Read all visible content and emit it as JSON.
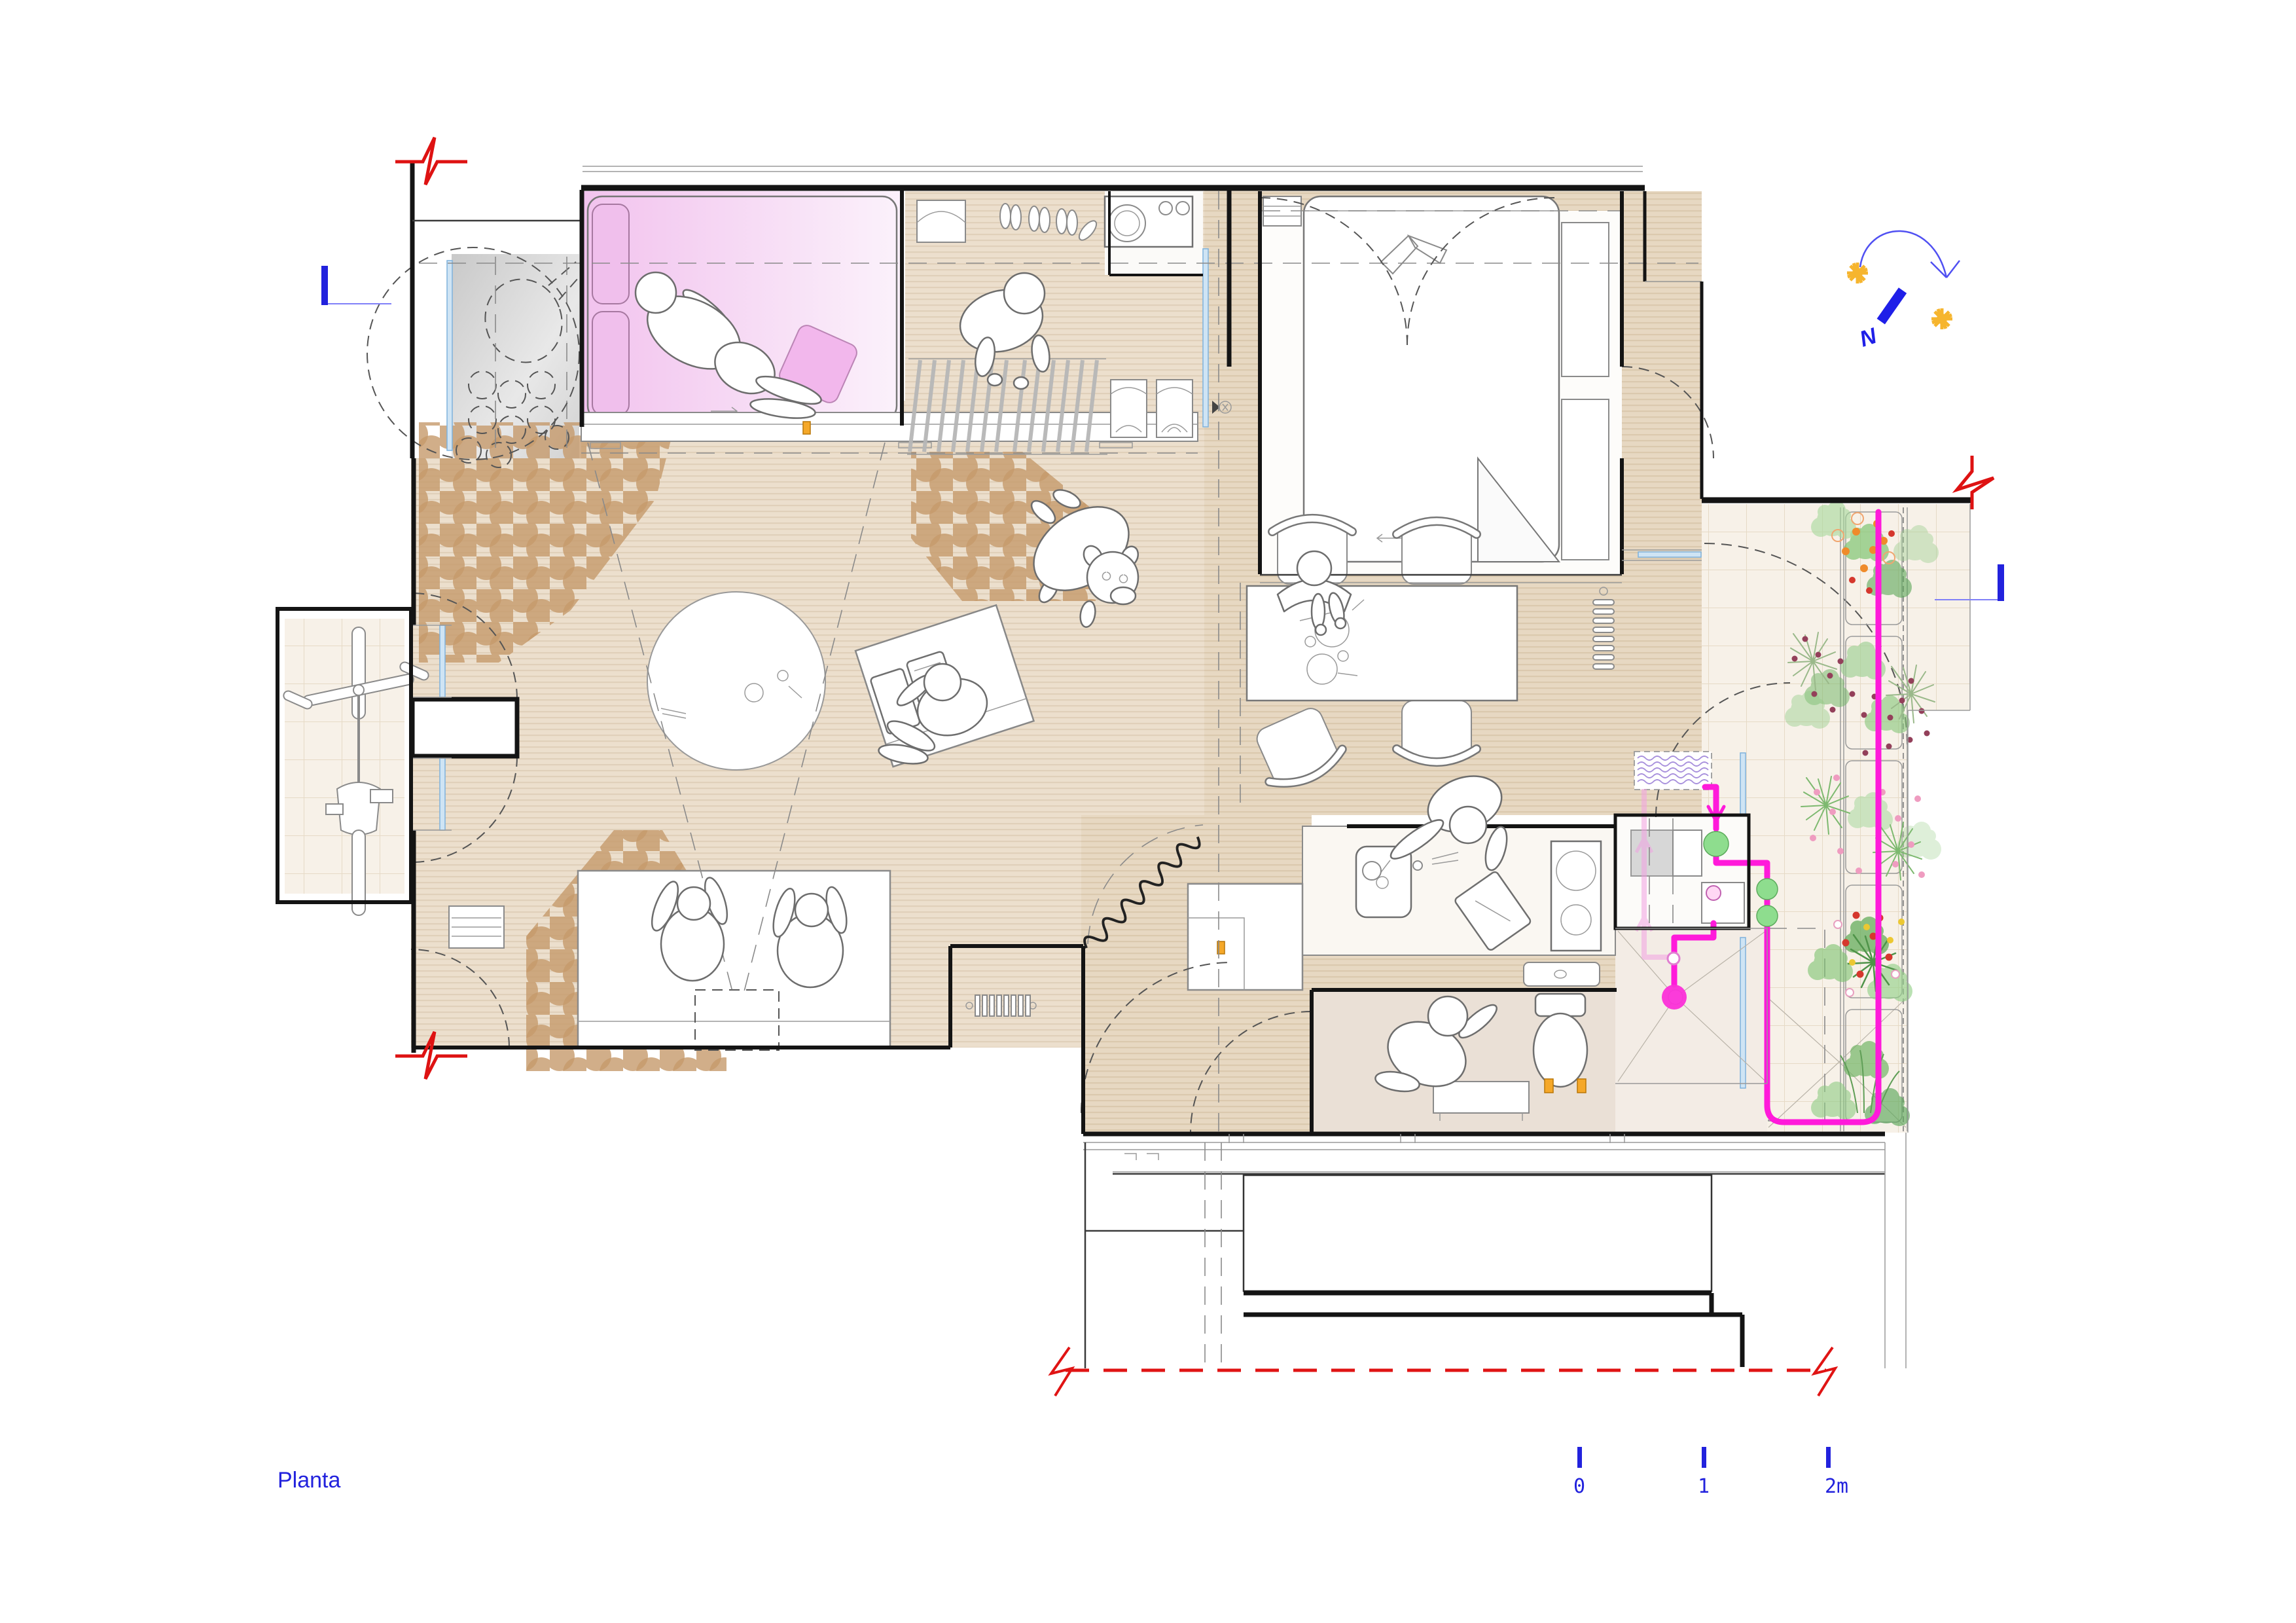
{
  "document": {
    "kind": "architectural-floor-plan",
    "sheet_title": "Planta"
  },
  "title": {
    "label": "Planta"
  },
  "scale_bar": {
    "unit": "m",
    "ticks": [
      "0",
      "1",
      "2m"
    ]
  },
  "compass": {
    "label": "N"
  },
  "colors": {
    "accent_blue": "#2222dd",
    "marker_blue_line": "#8080f8",
    "section_red": "#de1212",
    "pipe_magenta": "#ff1ada",
    "pipe_magenta_faded": "#f2a2e2",
    "drain_magenta": "#fb30d8",
    "water_node_green": "#8edd8e",
    "tank_wave_purple": "#a78fdc",
    "plant_green": "#6fbf63",
    "flower_orange": "#ef8b2b",
    "flower_red": "#d5372d",
    "flower_yellow": "#ecc832",
    "flower_pink": "#ef9cc0",
    "flower_maroon": "#93405a",
    "cork_brown": "#c59a6b",
    "wood_floor": "#ecdfcd",
    "wood_floor_dark": "#e7d8c2",
    "tile_cream": "#f7f1e8",
    "bathroom_floor": "#eae0d6",
    "bedroom_pink": "#f2c9ee",
    "glazing_blue": "#8fc3ea",
    "fixture_orange": "#f5a829",
    "terrace_gray": "#d9d9d9",
    "wall_black": "#141414"
  },
  "symbols": {
    "north_arrow": "compass needle with sun-path arc and two suns",
    "sun_icons": 2,
    "section_cut_marks": 3,
    "break_line_red_dashed": 1,
    "elevation_tick_marks": 2
  }
}
